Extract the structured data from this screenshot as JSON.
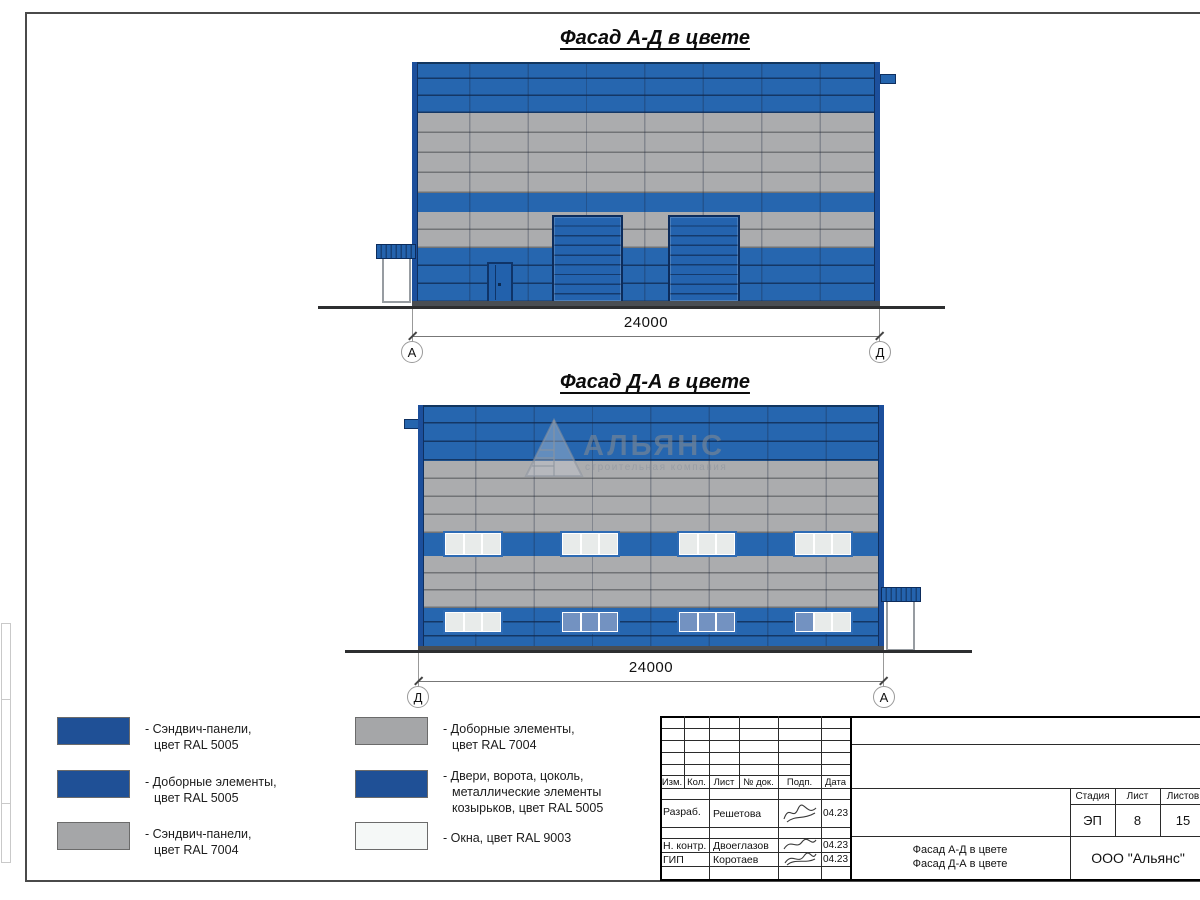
{
  "facade1": {
    "title": "Фасад А-Д в цвете",
    "dimension": "24000",
    "axis_left": "А",
    "axis_right": "Д"
  },
  "facade2": {
    "title": "Фасад Д-А в цвете",
    "dimension": "24000",
    "axis_left": "Д",
    "axis_right": "А"
  },
  "watermark": {
    "brand": "АЛЬЯНС",
    "tagline": "строительная компания"
  },
  "legend": {
    "items": [
      {
        "color": "#1F5096",
        "lines": [
          "- Сэндвич-панели,",
          "цвет RAL 5005"
        ]
      },
      {
        "color": "#1F5096",
        "lines": [
          "- Доборные элементы,",
          "цвет RAL 5005"
        ]
      },
      {
        "color": "#A5A6A8",
        "lines": [
          "- Сэндвич-панели,",
          "цвет RAL 7004"
        ]
      },
      {
        "color": "#A5A6A8",
        "lines": [
          "- Доборные элементы,",
          "цвет RAL 7004"
        ]
      },
      {
        "color": "#1F5096",
        "lines": [
          "- Двери, ворота, цоколь,",
          "металлические элементы",
          "козырьков, цвет RAL 5005"
        ]
      },
      {
        "color": "#F5F8F7",
        "lines": [
          "- Окна, цвет RAL 9003"
        ]
      }
    ]
  },
  "title_block": {
    "cols": [
      "Изм.",
      "Кол.",
      "Лист",
      "№ док.",
      "Подп.",
      "Дата"
    ],
    "sign_rows": [
      {
        "role": "Разраб.",
        "name": "Решетова",
        "date": "04.23"
      },
      {
        "role": "Н. контр.",
        "name": "Двоеглазов",
        "date": "04.23"
      },
      {
        "role": "ГИП",
        "name": "Коротаев",
        "date": "04.23"
      }
    ],
    "stage_cols": [
      "Стадия",
      "Лист",
      "Листов"
    ],
    "stage": "ЭП",
    "sheet_no": "8",
    "sheet_total": "15",
    "doc_line1": "Фасад А-Д в цвете",
    "doc_line2": "Фасад Д-А в цвете",
    "company": "ООО \"Альянс\""
  },
  "colors": {
    "panel_blue": "#2666AF",
    "panel_gray": "#ABACAE",
    "trim_blue": "#1C4F9C",
    "gate_blue": "#2463AE",
    "legend_blue_ral5005": "#1F5096",
    "legend_gray_ral7004": "#A5A6A8",
    "window_white_ral9003": "#F5F8F7",
    "window_tinted_blue": "#7392C1"
  }
}
